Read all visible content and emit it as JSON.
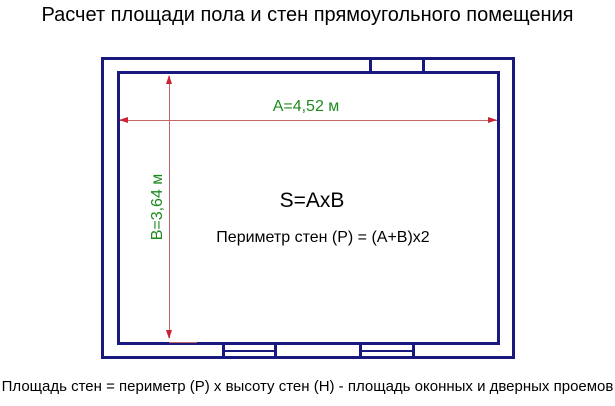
{
  "title": "Расчет площади пола и стен прямоугольного помещения",
  "footer": "Площадь стен = периметр (Р) х высоту стен (Н) - площадь оконных и дверных проемов",
  "diagram": {
    "width_label": "A=4,52 м",
    "height_label": "B=3,64 м",
    "area_formula": "S=AxB",
    "perimeter_formula": "Периметр стен (Р) = (А+В)х2",
    "colors": {
      "wall": "#191980",
      "dimension_line": "#c46767",
      "dimension_arrow": "#cc2233",
      "dimension_label": "#1e8a1e",
      "text": "#000000",
      "background": "#ffffff"
    }
  }
}
